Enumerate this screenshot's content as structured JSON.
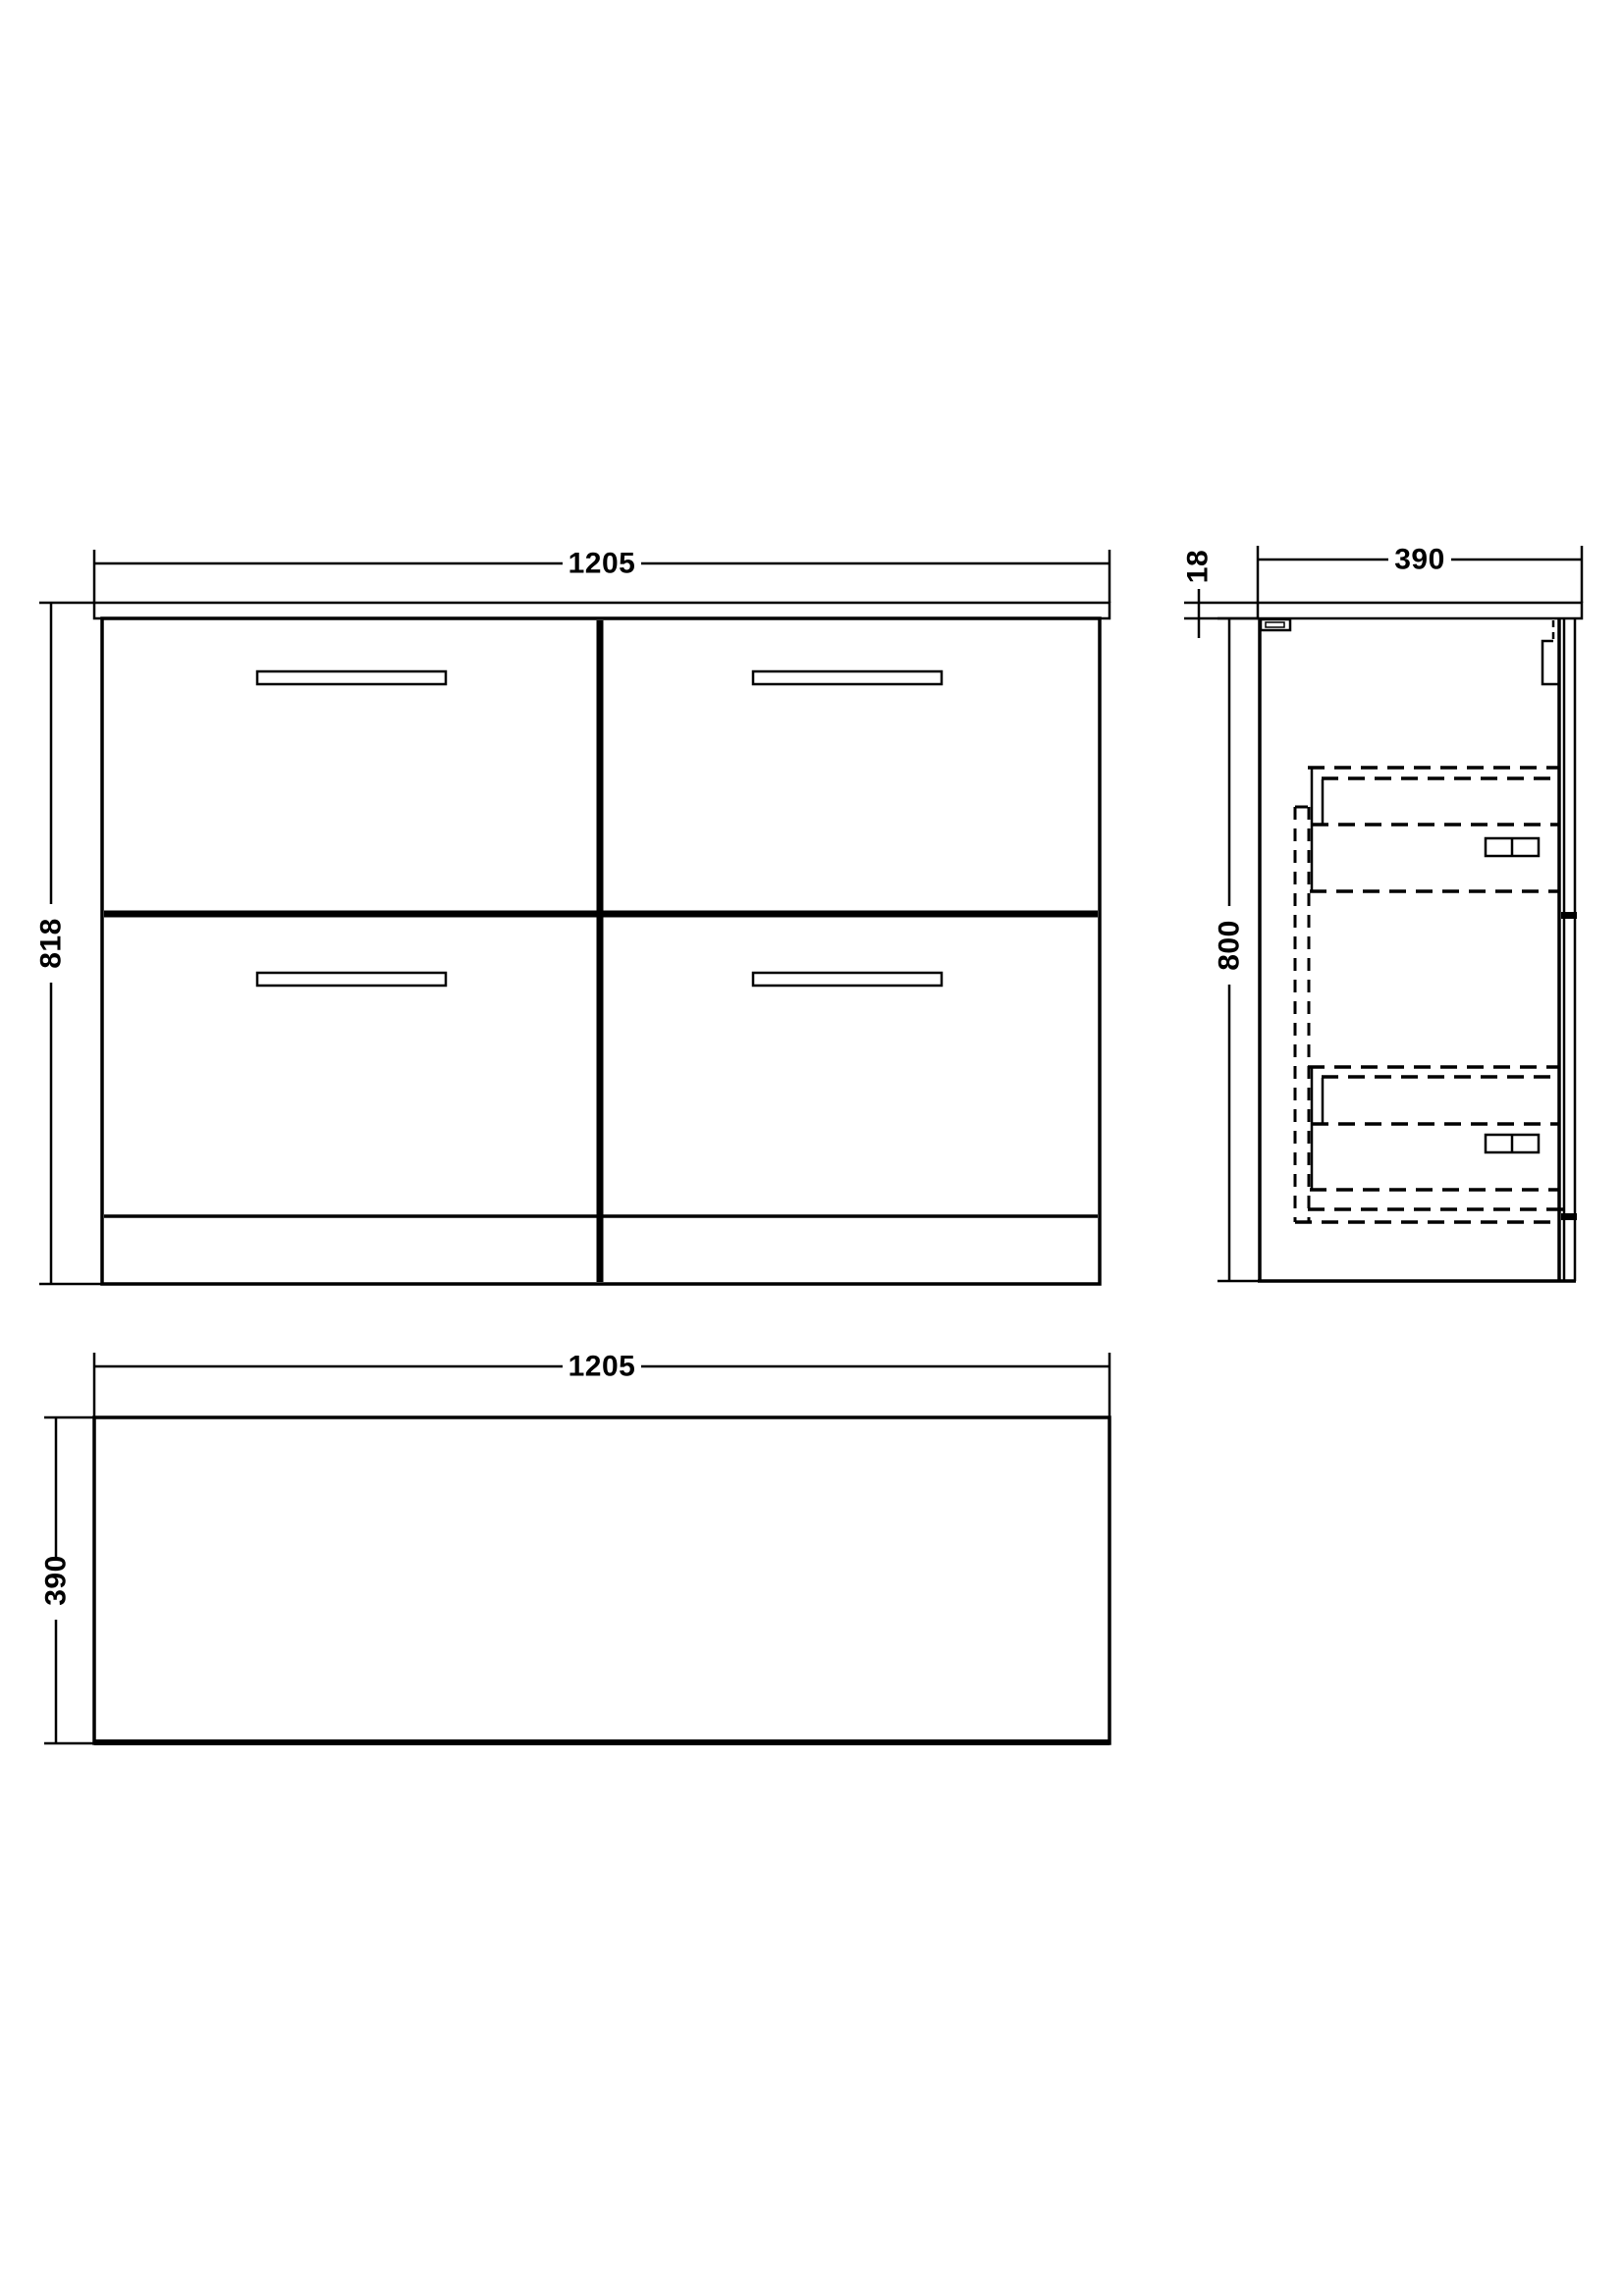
{
  "colors": {
    "line": "#000000",
    "background": "#ffffff"
  },
  "views": {
    "front": {
      "name": "front-elevation",
      "width_label": "1205",
      "height_label": "818",
      "drawer_count": 4
    },
    "side": {
      "name": "side-section",
      "depth_label": "390",
      "counter_thickness_label": "18",
      "height_label": "800"
    },
    "plan": {
      "name": "plan-view",
      "width_label": "1205",
      "depth_label": "390"
    }
  }
}
